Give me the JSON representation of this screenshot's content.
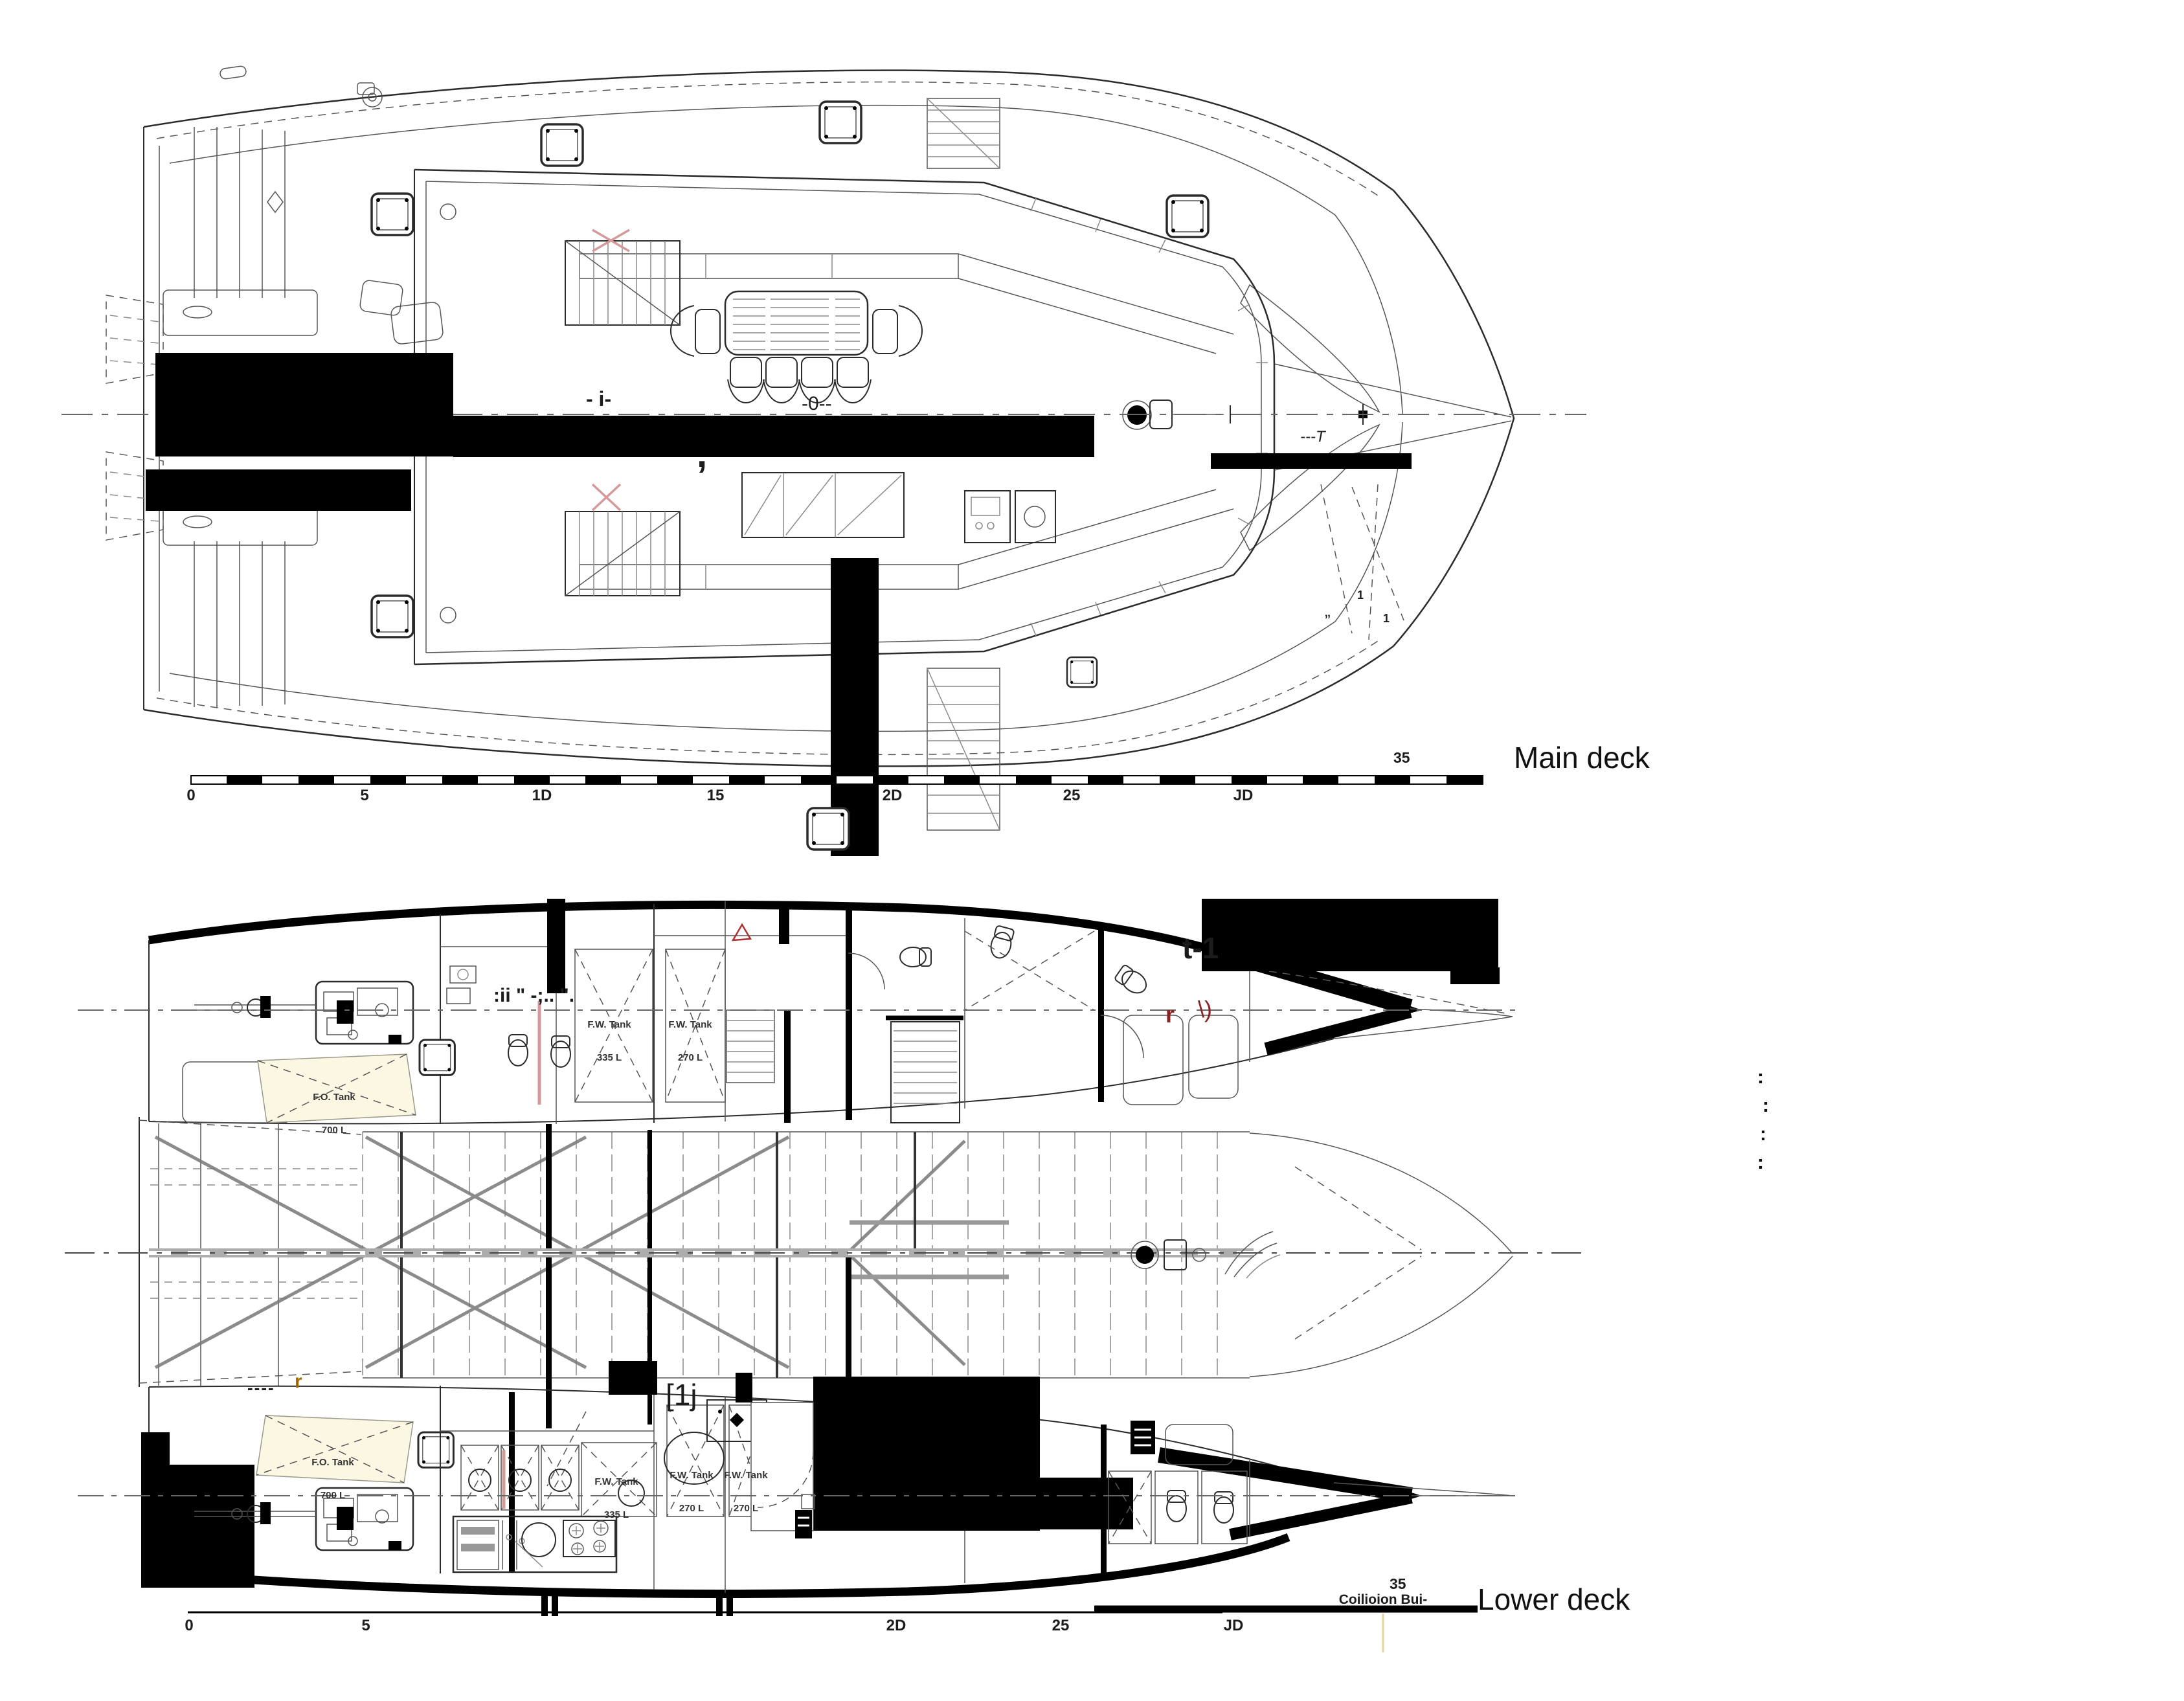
{
  "main_deck": {
    "title": "Main deck",
    "scale_end": "35",
    "ruler": [
      "0",
      "5",
      "1D",
      "15",
      "2D",
      "25",
      "JD"
    ],
    "fragments": {
      "dash_i": "- i-",
      "dash_zero": "-0--",
      "comma": ",",
      "t_note": "---T",
      "quote": "„",
      "one_a": "1",
      "one_b": "1"
    }
  },
  "lower_deck": {
    "title": "Lower deck",
    "scale_end": "35",
    "collision": "Coilioion Bui-",
    "ruler": [
      "0",
      "5",
      "2D",
      "25",
      "JD"
    ],
    "fragments": {
      "t1": "t-1",
      "colon_marks": ":ii \" -;.. \".",
      "r_red": "r",
      "paren_red": "\\)",
      "bracket_1j": "[1j",
      "dash_r": "----",
      "r_orange": "r",
      "dots": [
        ":",
        ":",
        ":",
        ":"
      ]
    },
    "tanks": [
      {
        "name": "F.O. Tank",
        "volume": "700 L"
      },
      {
        "name": "F.W. Tank",
        "volume": "335 L"
      },
      {
        "name": "F.W. Tank",
        "volume": "270 L"
      },
      {
        "name": "F.O. Tank",
        "volume": "700 L"
      },
      {
        "name": "F.W. Tank",
        "volume": "335 L"
      },
      {
        "name": "F.W. Tank",
        "volume": "270 L"
      },
      {
        "name": "F.W. Tank",
        "volume": "270 L"
      }
    ]
  },
  "colors": {
    "ink": "#2b2b2b",
    "redaction": "#000000",
    "accent_red": "#8b2222",
    "accent_orange": "#a36a00",
    "tank_tint": "#fbf7e2"
  }
}
